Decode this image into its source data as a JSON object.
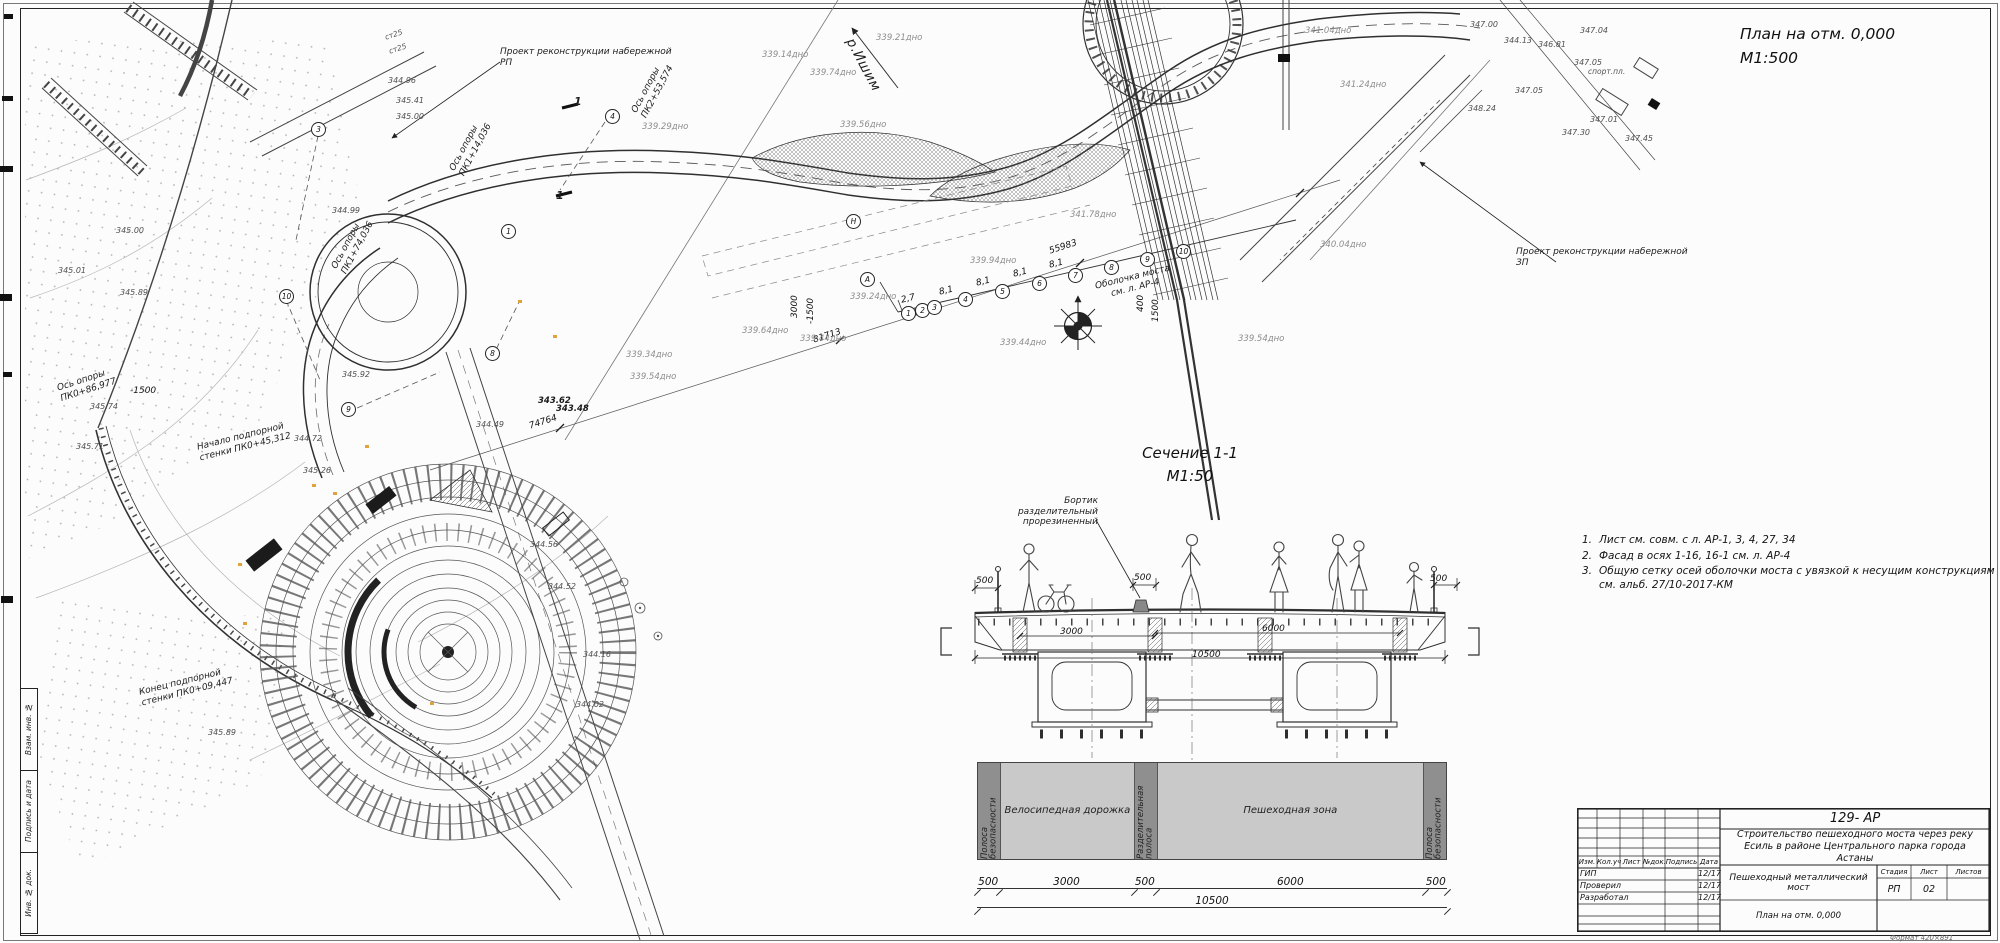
{
  "colors": {
    "paper": "#fcfcfc",
    "line": "#2b2b2b",
    "depth_text": "#8d8d8d",
    "zone_dark": "#8f8f8f",
    "zone_light": "#c9c9c9",
    "marker_orange": "#e0a33c"
  },
  "titles": {
    "plan": "План на отм. 0,000",
    "plan_scale": "М1:500",
    "section": "Сечение 1-1",
    "section_scale": "М1:50"
  },
  "notes": [
    {
      "n": "1.",
      "t": "Лист см. совм. с л. АР-1, 3, 4, 27, 34"
    },
    {
      "n": "2.",
      "t": "Фасад в осях 1-16, 16-1 см. л. АР-4"
    },
    {
      "n": "3.",
      "t": "Общую сетку осей оболочки моста с увязкой к несущим конструкциям см. альб. 27/10-2017-КМ"
    }
  ],
  "plan_labels": [
    {
      "t": "Проект реконструкции набережной\nРП",
      "x": 500,
      "y": 47
    },
    {
      "t": "Проект реконструкции набережной\nЗП",
      "x": 1516,
      "y": 247
    },
    {
      "t": "р.Ишим",
      "x": 856,
      "y": 36,
      "rot": 62,
      "cls": "lg"
    },
    {
      "t": "Оболочка моста\nсм. л. АР-4",
      "x": 1078,
      "y": 286,
      "rot": -14,
      "cls": "center"
    },
    {
      "t": "Бортик разделительный\nпрорезиненный",
      "x": 990,
      "y": 496,
      "cls": "right"
    },
    {
      "t": "Ось опоры\nПК0+86,977",
      "x": 56,
      "y": 384,
      "rot": -18
    },
    {
      "t": "Ось опоры\nПК1+14,036",
      "x": 448,
      "y": 168,
      "rot": -62
    },
    {
      "t": "Ось опоры\nПК2+53,574",
      "x": 630,
      "y": 110,
      "rot": -62
    },
    {
      "t": "Ось опоры\nПК1+74,036",
      "x": 330,
      "y": 266,
      "rot": -62
    },
    {
      "t": "Начало подпорной\nстенки ПК0+45,312",
      "x": 196,
      "y": 443,
      "rot": -14
    },
    {
      "t": "Конец подпорной\nстенки ПК0+09,447",
      "x": 138,
      "y": 688,
      "rot": -14
    },
    {
      "t": "55983",
      "x": 1048,
      "y": 247,
      "rot": -18,
      "cls": "dim"
    },
    {
      "t": "81713",
      "x": 812,
      "y": 336,
      "rot": -18,
      "cls": "dim"
    },
    {
      "t": "74764",
      "x": 528,
      "y": 422,
      "rot": -18,
      "cls": "dim"
    },
    {
      "t": "3000",
      "x": 790,
      "y": 318,
      "rot": -90,
      "cls": "dim"
    },
    {
      "t": "-1500",
      "x": 806,
      "y": 324,
      "rot": -90,
      "cls": "dim"
    },
    {
      "t": "400",
      "x": 1136,
      "y": 312,
      "rot": -90,
      "cls": "dim"
    },
    {
      "t": "1500",
      "x": 1151,
      "y": 322,
      "rot": -90,
      "cls": "dim"
    },
    {
      "t": "-1500",
      "x": 130,
      "y": 386,
      "cls": "dim"
    },
    {
      "t": "8,1",
      "x": 938,
      "y": 288,
      "rot": -14,
      "cls": "dim"
    },
    {
      "t": "8,1",
      "x": 975,
      "y": 279,
      "rot": -14,
      "cls": "dim"
    },
    {
      "t": "8,1",
      "x": 1012,
      "y": 270,
      "rot": -14,
      "cls": "dim"
    },
    {
      "t": "8,1",
      "x": 1048,
      "y": 261,
      "rot": -14,
      "cls": "dim"
    },
    {
      "t": "2,7",
      "x": 900,
      "y": 296,
      "rot": -14,
      "cls": "dim"
    },
    {
      "t": "спорт.пл.",
      "x": 1588,
      "y": 68,
      "cls": "small"
    },
    {
      "t": "ст25",
      "x": 384,
      "y": 34,
      "rot": -18,
      "cls": "small"
    },
    {
      "t": "ст25",
      "x": 388,
      "y": 48,
      "rot": -18,
      "cls": "small"
    },
    {
      "t": "1",
      "x": 574,
      "y": 96,
      "cls": "sec"
    },
    {
      "t": "1",
      "x": 556,
      "y": 190,
      "cls": "sec"
    },
    {
      "t": "339.21дно",
      "x": 876,
      "y": 33,
      "cls": "depth"
    },
    {
      "t": "339.14дно",
      "x": 762,
      "y": 50,
      "cls": "depth"
    },
    {
      "t": "339.74дно",
      "x": 810,
      "y": 68,
      "cls": "depth"
    },
    {
      "t": "339.56дно",
      "x": 840,
      "y": 120,
      "cls": "depth"
    },
    {
      "t": "339.29дно",
      "x": 642,
      "y": 122,
      "cls": "depth"
    },
    {
      "t": "341.04дно",
      "x": 1305,
      "y": 26,
      "cls": "depth"
    },
    {
      "t": "341.24дно",
      "x": 1340,
      "y": 80,
      "cls": "depth"
    },
    {
      "t": "341.78дно",
      "x": 1070,
      "y": 210,
      "cls": "depth"
    },
    {
      "t": "340.04дно",
      "x": 1320,
      "y": 240,
      "cls": "depth"
    },
    {
      "t": "339.94дно",
      "x": 970,
      "y": 256,
      "cls": "depth"
    },
    {
      "t": "339.44дно",
      "x": 800,
      "y": 334,
      "cls": "depth"
    },
    {
      "t": "339.44дно",
      "x": 1000,
      "y": 338,
      "cls": "depth"
    },
    {
      "t": "339.54дно",
      "x": 1238,
      "y": 334,
      "cls": "depth"
    },
    {
      "t": "339.64дно",
      "x": 742,
      "y": 326,
      "cls": "depth"
    },
    {
      "t": "339.34дно",
      "x": 626,
      "y": 350,
      "cls": "depth"
    },
    {
      "t": "339.54дно",
      "x": 630,
      "y": 372,
      "cls": "depth"
    },
    {
      "t": "339.24дно",
      "x": 850,
      "y": 292,
      "cls": "depth"
    },
    {
      "t": "345.00",
      "x": 116,
      "y": 226,
      "cls": "elev"
    },
    {
      "t": "345.01",
      "x": 58,
      "y": 266,
      "cls": "elev"
    },
    {
      "t": "345.71",
      "x": 76,
      "y": 442,
      "cls": "elev"
    },
    {
      "t": "345.74",
      "x": 90,
      "y": 402,
      "cls": "elev"
    },
    {
      "t": "345.89",
      "x": 120,
      "y": 288,
      "cls": "elev"
    },
    {
      "t": "345.89",
      "x": 208,
      "y": 728,
      "cls": "elev"
    },
    {
      "t": "344.96",
      "x": 388,
      "y": 76,
      "cls": "elev"
    },
    {
      "t": "345.41",
      "x": 396,
      "y": 96,
      "cls": "elev"
    },
    {
      "t": "345.00",
      "x": 396,
      "y": 112,
      "cls": "elev"
    },
    {
      "t": "344.99",
      "x": 332,
      "y": 206,
      "cls": "elev"
    },
    {
      "t": "345.92",
      "x": 342,
      "y": 370,
      "cls": "elev"
    },
    {
      "t": "343.62",
      "x": 538,
      "y": 396,
      "cls": "elevb"
    },
    {
      "t": "343.48",
      "x": 556,
      "y": 404,
      "cls": "elevb"
    },
    {
      "t": "344.49",
      "x": 476,
      "y": 420,
      "cls": "elev"
    },
    {
      "t": "344.72",
      "x": 294,
      "y": 434,
      "cls": "elev"
    },
    {
      "t": "345.26",
      "x": 303,
      "y": 466,
      "cls": "elev"
    },
    {
      "t": "344.56",
      "x": 530,
      "y": 540,
      "cls": "elev"
    },
    {
      "t": "344.52",
      "x": 548,
      "y": 582,
      "cls": "elev"
    },
    {
      "t": "344.16",
      "x": 583,
      "y": 650,
      "cls": "elev"
    },
    {
      "t": "344.02",
      "x": 576,
      "y": 700,
      "cls": "elev"
    },
    {
      "t": "347.00",
      "x": 1470,
      "y": 20,
      "cls": "elev"
    },
    {
      "t": "344.13",
      "x": 1504,
      "y": 36,
      "cls": "elev"
    },
    {
      "t": "346.81",
      "x": 1538,
      "y": 40,
      "cls": "elev"
    },
    {
      "t": "347.04",
      "x": 1580,
      "y": 26,
      "cls": "elev"
    },
    {
      "t": "347.05",
      "x": 1574,
      "y": 58,
      "cls": "elev"
    },
    {
      "t": "347.05",
      "x": 1515,
      "y": 86,
      "cls": "elev"
    },
    {
      "t": "348.24",
      "x": 1468,
      "y": 104,
      "cls": "elev"
    },
    {
      "t": "347.30",
      "x": 1562,
      "y": 128,
      "cls": "elev"
    },
    {
      "t": "347.01",
      "x": 1590,
      "y": 115,
      "cls": "elev"
    },
    {
      "t": "347.45",
      "x": 1625,
      "y": 134,
      "cls": "elev"
    },
    {
      "t": "500",
      "x": 976,
      "y": 576,
      "cls": "dim"
    },
    {
      "t": "500",
      "x": 1134,
      "y": 573,
      "cls": "dim"
    },
    {
      "t": "500",
      "x": 1430,
      "y": 574,
      "cls": "dim"
    },
    {
      "t": "3000",
      "x": 1060,
      "y": 627,
      "cls": "dim"
    },
    {
      "t": "6000",
      "x": 1262,
      "y": 624,
      "cls": "dim"
    },
    {
      "t": "10500",
      "x": 1192,
      "y": 650,
      "cls": "dim"
    }
  ],
  "axis_circles": [
    {
      "n": "1",
      "x": 901,
      "y": 306
    },
    {
      "n": "2",
      "x": 915,
      "y": 303
    },
    {
      "n": "3",
      "x": 927,
      "y": 300
    },
    {
      "n": "4",
      "x": 958,
      "y": 292
    },
    {
      "n": "5",
      "x": 995,
      "y": 284
    },
    {
      "n": "6",
      "x": 1032,
      "y": 276
    },
    {
      "n": "7",
      "x": 1068,
      "y": 268
    },
    {
      "n": "8",
      "x": 1104,
      "y": 260
    },
    {
      "n": "9",
      "x": 1140,
      "y": 252
    },
    {
      "n": "10",
      "x": 1176,
      "y": 244
    },
    {
      "n": "А",
      "x": 860,
      "y": 272
    },
    {
      "n": "Н",
      "x": 846,
      "y": 214
    },
    {
      "n": "3",
      "x": 311,
      "y": 122
    },
    {
      "n": "4",
      "x": 605,
      "y": 109
    },
    {
      "n": "1",
      "x": 501,
      "y": 224
    },
    {
      "n": "10",
      "x": 279,
      "y": 289
    },
    {
      "n": "9",
      "x": 341,
      "y": 402
    },
    {
      "n": "8",
      "x": 485,
      "y": 346
    }
  ],
  "zone_bar": {
    "zones": [
      {
        "label": "Полоса безопасности",
        "dim": "500"
      },
      {
        "label": "Велосипедная дорожка",
        "dim": "3000"
      },
      {
        "label": "Разделительная полоса",
        "dim": "500"
      },
      {
        "label": "Пешеходная зона",
        "dim": "6000"
      },
      {
        "label": "Полоса безопасности",
        "dim": "500"
      }
    ],
    "total": "10500"
  },
  "titleblock": {
    "code": "129- АР",
    "project": "Строительство пешеходного моста через реку Есиль в районе Центрального парка города Астаны",
    "object": "Пешеходный металлический мост",
    "drawing": "План на отм. 0,000",
    "header": [
      "Изм.",
      "Кол.уч",
      "Лист",
      "№док.",
      "Подпись",
      "Дата"
    ],
    "rows": [
      {
        "role": "ГИП",
        "date": "12/17"
      },
      {
        "role": "Проверил",
        "date": "12/17"
      },
      {
        "role": "Разработал",
        "date": "12/17"
      }
    ],
    "stage_label": "Стадия",
    "sheet_label": "Лист",
    "sheets_label": "Листов",
    "stage": "РП",
    "sheet": "02",
    "sheets": ""
  },
  "frame_strip": [
    "Взам. инв. №",
    "Подпись и дата",
    "Инв. № док."
  ],
  "format_note": "Формат 420×891"
}
